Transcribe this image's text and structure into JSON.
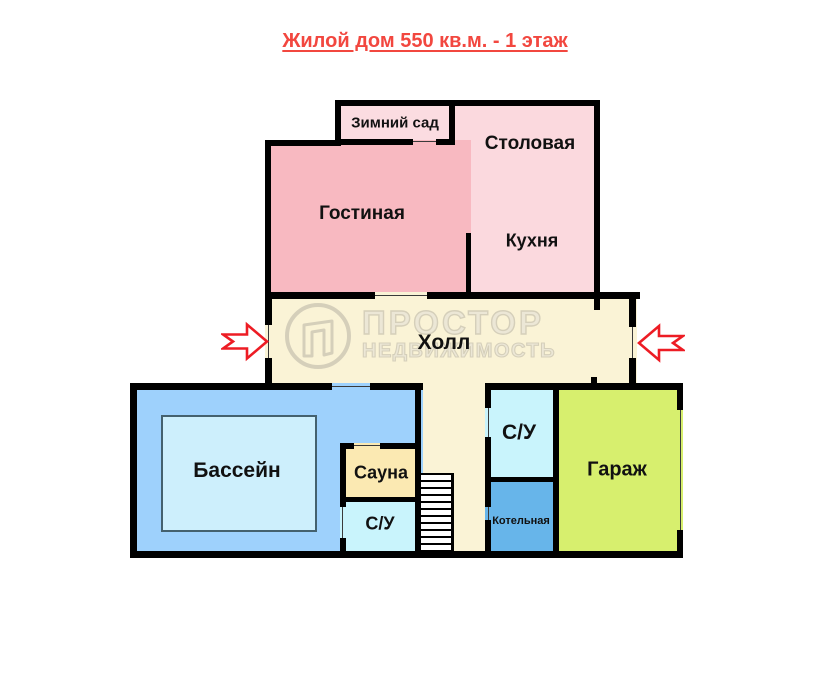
{
  "title": "Жилой дом 550 кв.м. - 1 этаж",
  "watermark": {
    "line1": "ПРОСТОР",
    "line2": "НЕДВИЖИМОСТЬ"
  },
  "rooms": {
    "winter_garden": {
      "label": "Зимний сад",
      "color": "#fbdce1"
    },
    "dining": {
      "label": "Столовая",
      "color": "#fbd9de"
    },
    "kitchen": {
      "label": "Кухня",
      "color": "#fbd9de"
    },
    "living_room": {
      "label": "Гостиная",
      "color": "#f8b9c1"
    },
    "hall": {
      "label": "Холл",
      "color": "#faf3d6"
    },
    "pool": {
      "label": "Бассейн",
      "color": "#9ed1fc"
    },
    "sauna": {
      "label": "Сауна",
      "color": "#fbe9b2"
    },
    "bathroom_pool": {
      "label": "С/У",
      "color": "#c9f4fc"
    },
    "bathroom_main": {
      "label": "С/У",
      "color": "#c9f4fc"
    },
    "boiler_room": {
      "label": "Котельная",
      "color": "#67b5ea"
    },
    "garage": {
      "label": "Гараж",
      "color": "#d7ef6e"
    }
  },
  "colors": {
    "wall": "#000000",
    "title_text": "#f2473f",
    "entrance_arrow": "#ed1c24",
    "watermark_outline": "#d5cfba",
    "pool_water": "#cdeffc",
    "background": "#ffffff"
  }
}
